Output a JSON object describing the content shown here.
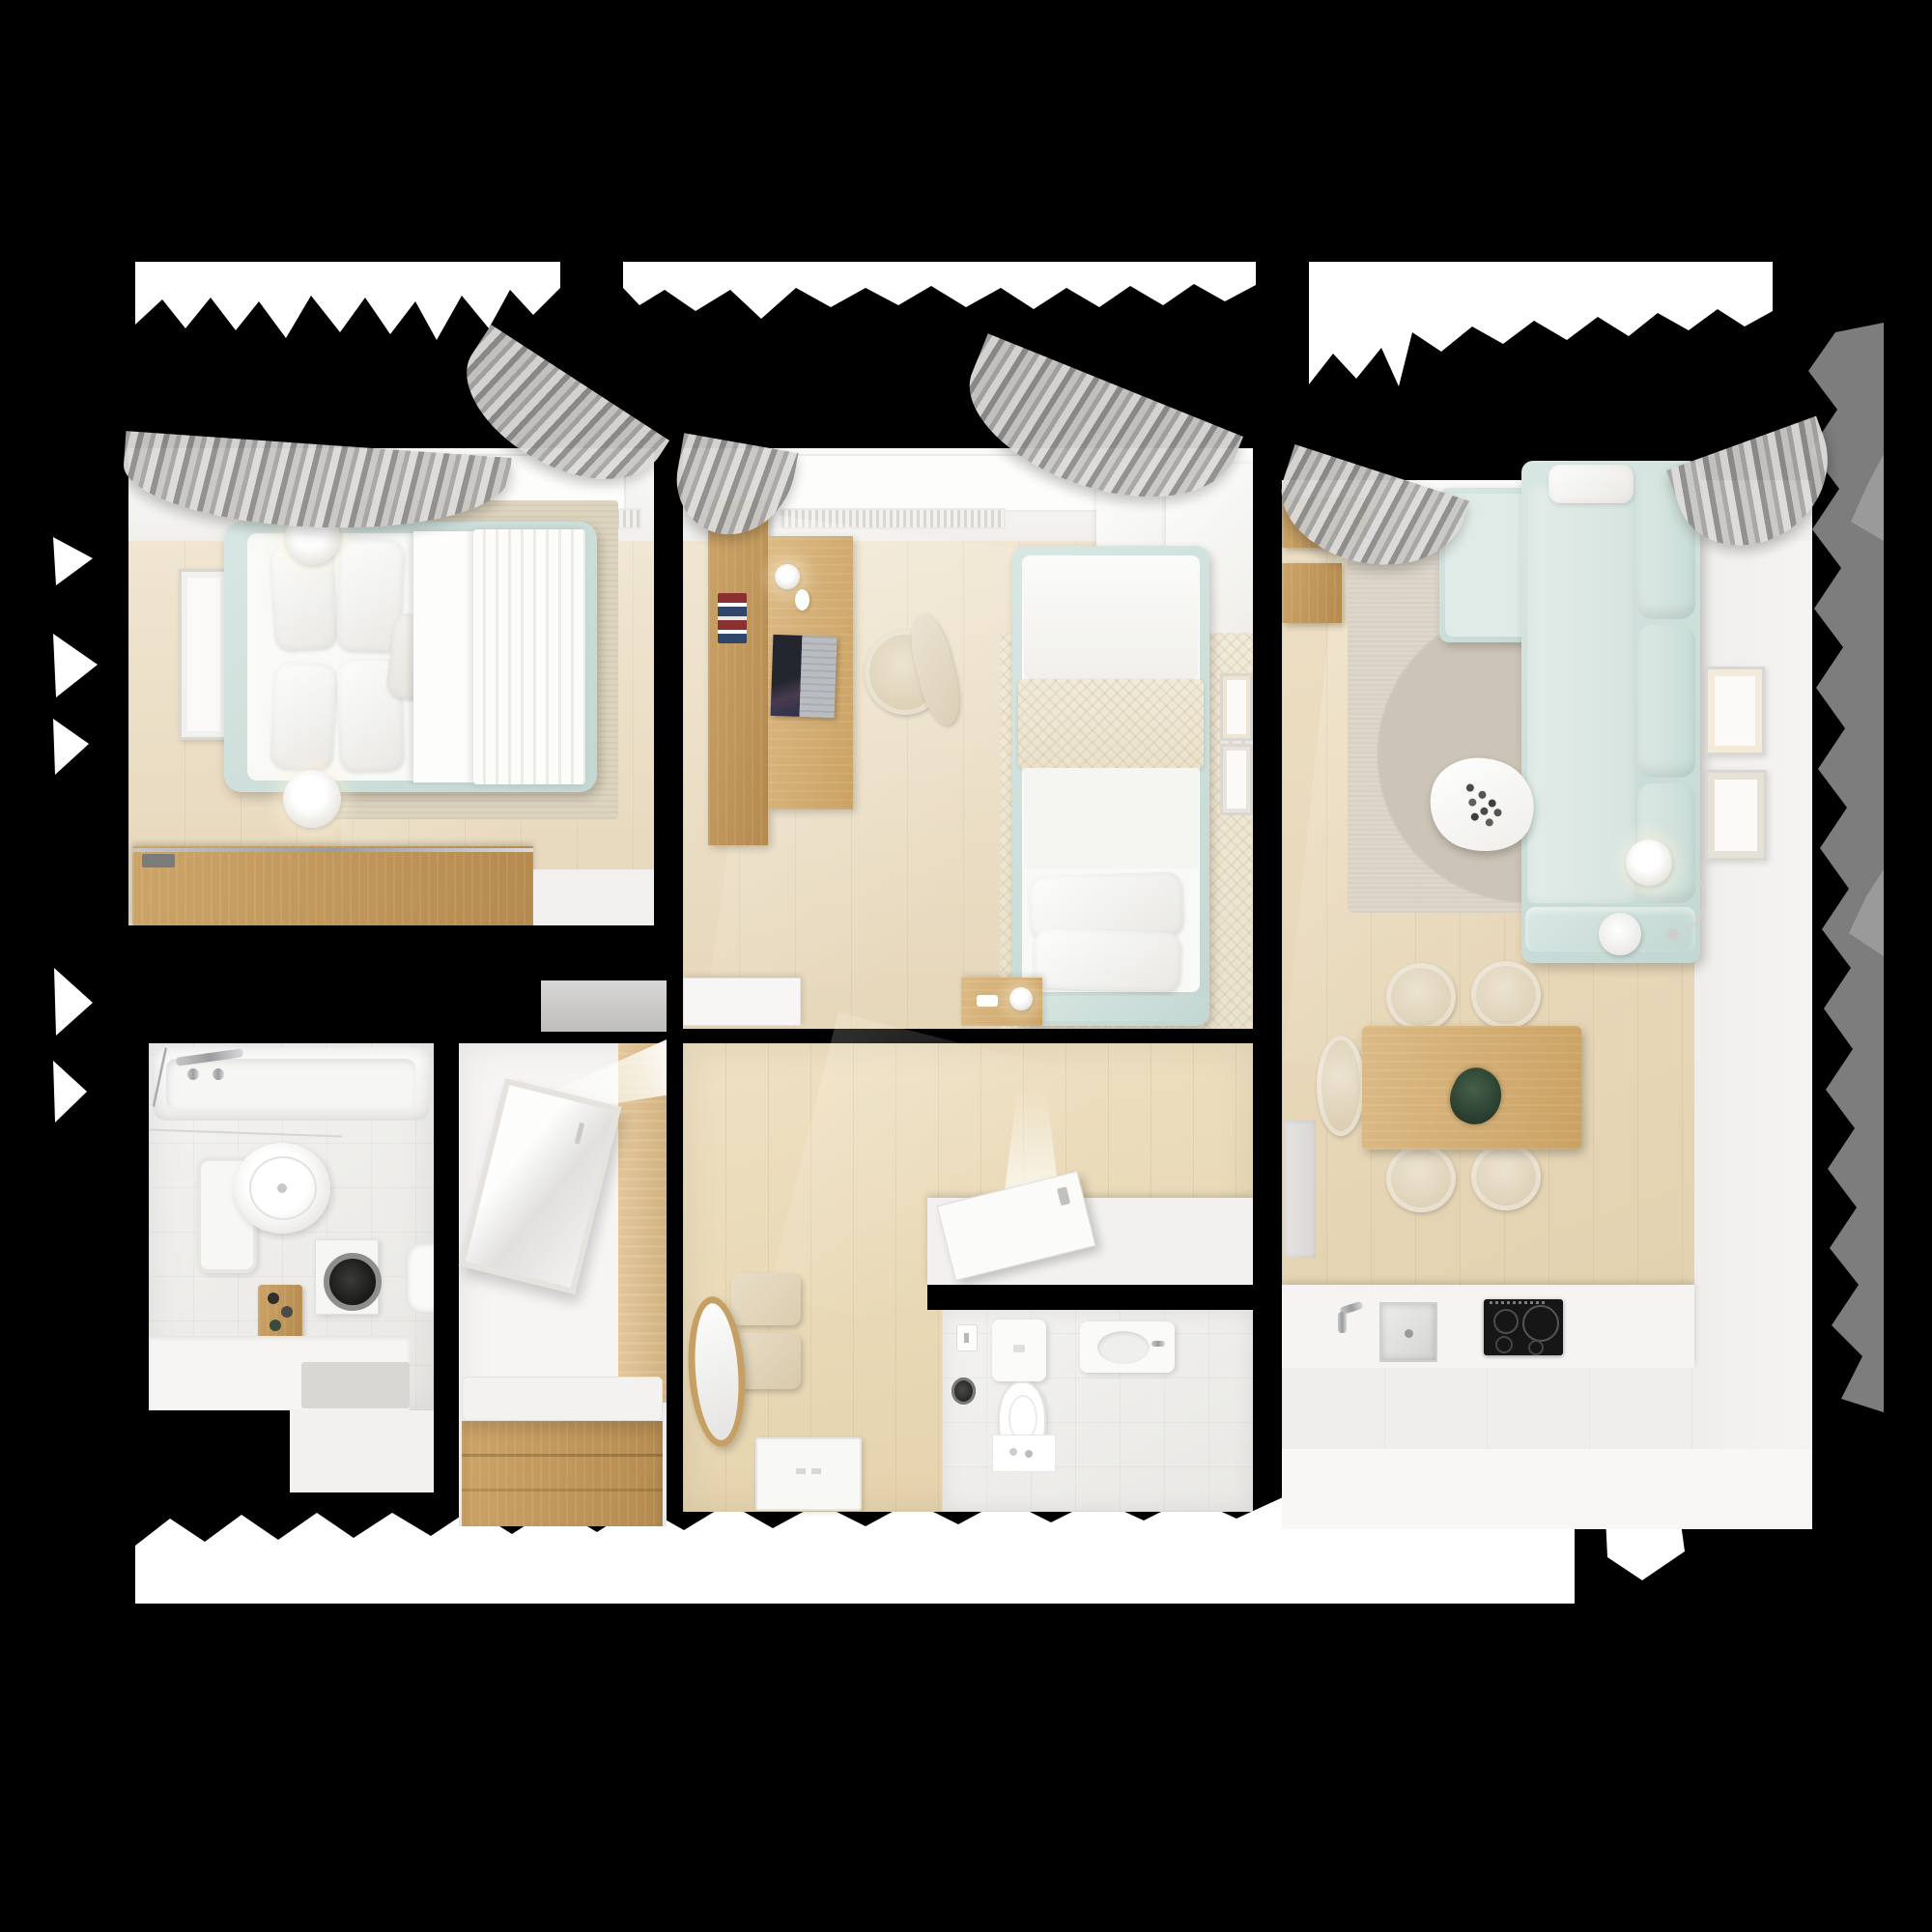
{
  "scene": {
    "type": "3d-floorplan-top-view",
    "description": "Top-down 3D rendering of a two-bedroom apartment floor plan on a black background with torn-paper edges",
    "background_color": "#000000"
  },
  "palette": {
    "background": "#000000",
    "wall_white": "#f5f4f2",
    "floor_wood_light": "#ecdfc8",
    "furniture_wood": "#c79d62",
    "accent_mint": "#d3e2de",
    "curtain_grey": "#b0afad",
    "torn_paper_white": "#ffffff",
    "torn_paper_grey": "#7d7d7d",
    "appliance_black": "#171717"
  },
  "rooms": [
    {
      "name": "Master Bedroom",
      "furniture": [
        "double bed with mint frame",
        "white bedding",
        "four pillows",
        "small cushion",
        "striped throw blanket",
        "two round bedside lamps",
        "beige area rug",
        "wall art frame",
        "wooden sliding-door wardrobe",
        "window with radiator",
        "grey curtains"
      ]
    },
    {
      "name": "Kids Bedroom",
      "furniture": [
        "single bed with mint frame",
        "beige herringbone throw",
        "two pillows",
        "wooden desk",
        "laptop",
        "desk lamp",
        "computer mouse",
        "books",
        "desk chair",
        "white corner wardrobe",
        "herringbone rug",
        "wooden nightstand with lamp",
        "white dresser",
        "two small wall frames",
        "window with radiator",
        "grey curtains"
      ]
    },
    {
      "name": "Living Room",
      "furniture": [
        "L-shaped mint sofa",
        "tufted back cushions",
        "white lumbar pillow",
        "organic white coffee table with decor",
        "round grey rug",
        "floor lamp",
        "round side table",
        "wooden wall shelves",
        "two wall art frames",
        "wooden dining table",
        "plant centerpiece",
        "five beige dining chairs",
        "window with radiator",
        "grey curtains"
      ]
    },
    {
      "name": "Kitchen",
      "furniture": [
        "white counter run",
        "stainless steel sink",
        "chrome faucet",
        "black induction cooktop with four burners",
        "white base cabinets"
      ]
    },
    {
      "name": "Bathroom",
      "furniture": [
        "bathtub with chrome fixtures",
        "round vessel sink",
        "wall mirror cabinet",
        "washing machine with dark porthole",
        "wooden toiletry caddy",
        "toilet at wall edge",
        "white low cabinet",
        "grey bath mat",
        "light tiled floor"
      ]
    },
    {
      "name": "Entry Closet",
      "furniture": [
        "leaning framed mirror",
        "wood panelled wall",
        "wooden bench with drawers",
        "white seat cushion",
        "light beam"
      ]
    },
    {
      "name": "Hallway",
      "furniture": [
        "open entry door with light beam",
        "white threshold platform",
        "white door panel on floor",
        "upholstered bench cushions",
        "oval wood-framed mirror",
        "wood floor"
      ]
    },
    {
      "name": "WC",
      "furniture": [
        "toilet with cistern",
        "wall-hung basin with tap",
        "light switch",
        "dark round accessory",
        "white mat with toiletries"
      ]
    }
  ]
}
